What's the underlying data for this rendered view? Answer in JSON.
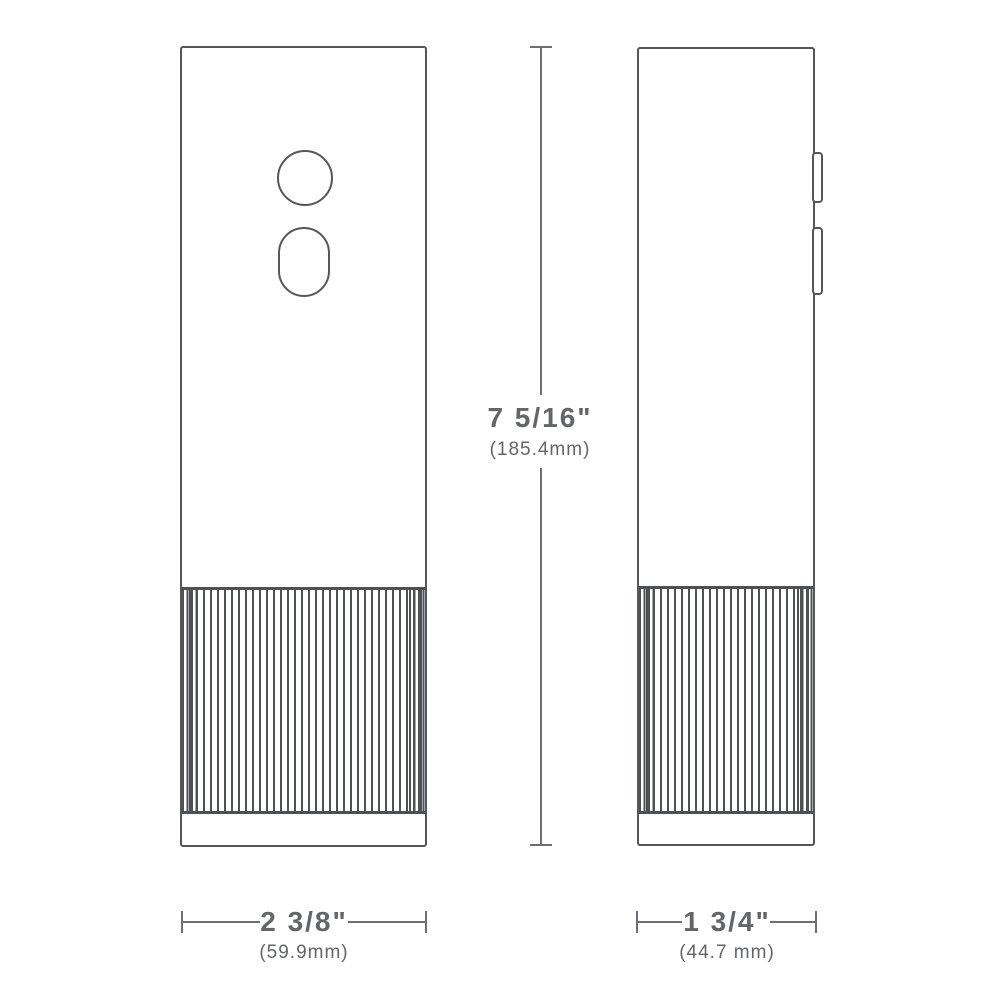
{
  "diagram": {
    "type": "product-dimension-drawing",
    "description": "Two orthographic line-drawing views (front and side) of a tall rectangular device with a round button, an oval trigger button, side buttons and a ribbed lower grip, annotated with dimension lines",
    "dimensions": {
      "height": {
        "label": "7 5/16\"",
        "metric": "(185.4mm)"
      },
      "width": {
        "label": "2 3/8\"",
        "metric": "(59.9mm)"
      },
      "depth": {
        "label": "1 3/4\"",
        "metric": "(44.7 mm)"
      }
    },
    "colors": {
      "background": "#ffffff",
      "outline": "#54565a",
      "rib": "#4e5054",
      "dimension_line": "#6e6f72",
      "text": "#636569"
    }
  }
}
